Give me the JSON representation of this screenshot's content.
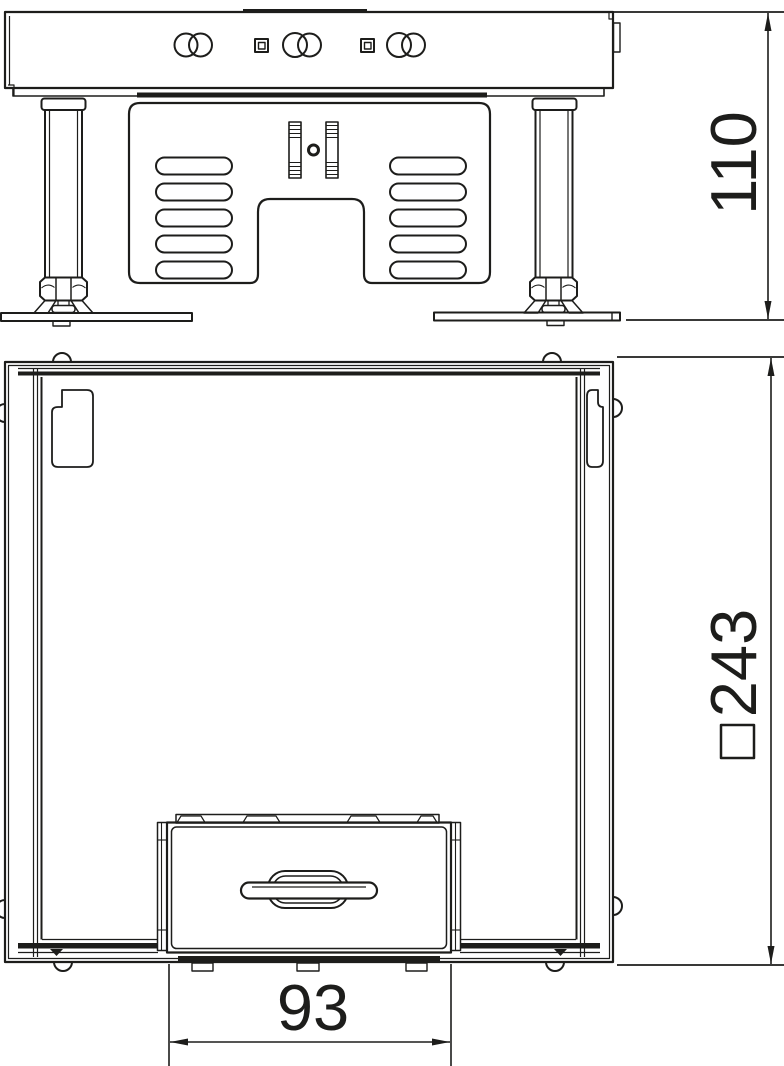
{
  "colors": {
    "line": "#1d1d1b",
    "background": "#ffffff"
  },
  "dimensions": {
    "height": {
      "value": "110"
    },
    "outer_width": {
      "symbol": "□",
      "value": "243"
    },
    "lid_width": {
      "value": "93"
    }
  }
}
